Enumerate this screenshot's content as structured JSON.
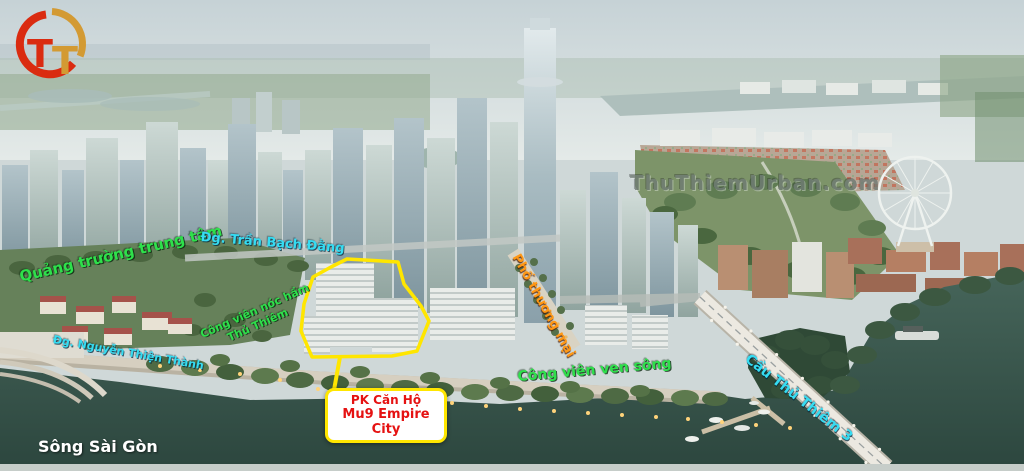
{
  "logo": {
    "t1": "T",
    "t2": "T"
  },
  "labels": {
    "central_square": "Quảng trường trung tâm",
    "tran_bach_dang": "Đg. Trần Bạch Đằng",
    "nguyen_thien_thanh": "Đg. Nguyễn Thiện Thành",
    "rooftop_park_line1": "Công viên nóc hầm",
    "rooftop_park_line2": "Thủ Thiêm",
    "shopping_street": "Phố thương mại",
    "riverside_park": "Công viên ven sông",
    "bridge": "Cầu Thủ Thiêm 3",
    "river": "Sông Sài Gòn"
  },
  "watermark": "ThuThiemUrban.com",
  "callout": {
    "line1": "PK Căn Hộ",
    "line2": "Mu9 Empire City"
  },
  "colors": {
    "green_label": "#2ee04b",
    "cyan_label": "#35dcf2",
    "orange_label": "#ff9714",
    "red_callout": "#e51212",
    "callout_border": "#ffe600",
    "highlight_outline": "#ffe600",
    "watermark": "#6f7a74",
    "logo_red": "#da2b10",
    "logo_gold": "#d39a33"
  }
}
